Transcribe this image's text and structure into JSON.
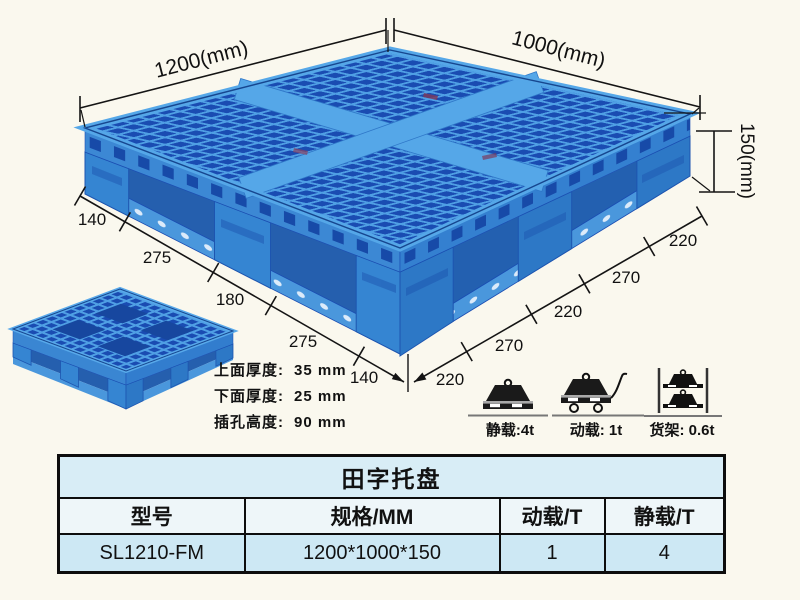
{
  "page": {
    "background": "#faf8ee"
  },
  "drawing": {
    "length_label": "1200(mm)",
    "width_label": "1000(mm)",
    "height_label": "150(mm)",
    "bottom_left_dims": [
      "140",
      "275",
      "180",
      "275",
      "140"
    ],
    "bottom_right_dims": [
      "220",
      "270",
      "220",
      "270",
      "220"
    ]
  },
  "specs": [
    {
      "label": "上面厚度:",
      "value": "35 mm"
    },
    {
      "label": "下面厚度:",
      "value": "25 mm"
    },
    {
      "label": "插孔高度:",
      "value": "90 mm"
    }
  ],
  "load_ratings": [
    {
      "icon": "static-load-icon",
      "label": "静载:4t"
    },
    {
      "icon": "dynamic-load-icon",
      "label": "动载: 1t"
    },
    {
      "icon": "rack-load-icon",
      "label": "货架: 0.6t"
    }
  ],
  "table": {
    "title": "田字托盘",
    "headers": [
      "型号",
      "规格/MM",
      "动载/T",
      "静载/T"
    ],
    "rows": [
      [
        "SL1210-FM",
        "1200*1000*150",
        "1",
        "4"
      ]
    ]
  },
  "colors": {
    "pallet_light": "#4f9fe4",
    "pallet_mid": "#3585d2",
    "pallet_dark": "#1a4cb2",
    "table_title_bg": "#d8edf6",
    "table_header_bg": "#eef6f9",
    "table_row_bg": "#cde8f4",
    "dimension_line": "#141414"
  }
}
